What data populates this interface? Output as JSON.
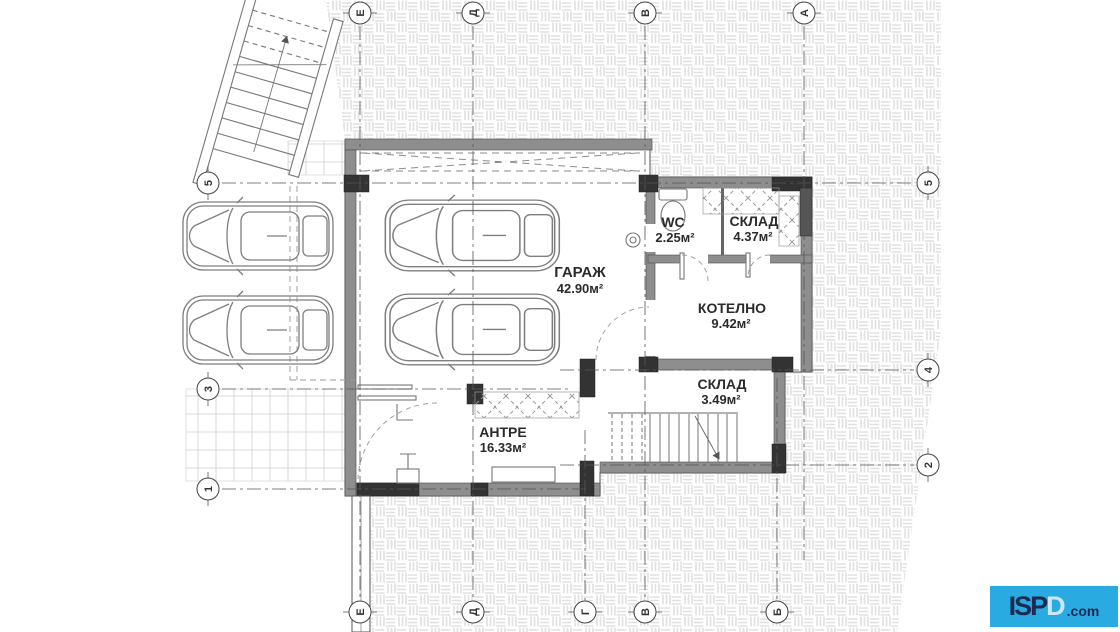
{
  "plan": {
    "rooms": [
      {
        "id": "garage",
        "name": "ГАРАЖ",
        "area": "42.90м²"
      },
      {
        "id": "wc",
        "name": "WC",
        "area": "2.25м²"
      },
      {
        "id": "sklad1",
        "name": "СКЛАД",
        "area": "4.37м²"
      },
      {
        "id": "kotelno",
        "name": "КОТЕЛНО",
        "area": "9.42м²"
      },
      {
        "id": "sklad2",
        "name": "СКЛАД",
        "area": "3.49м²"
      },
      {
        "id": "antre",
        "name": "АНТРЕ",
        "area": "16.33м²"
      }
    ],
    "grid": {
      "top": [
        "Е",
        "Д",
        "В",
        "А"
      ],
      "bottom": [
        "Е",
        "Д",
        "Г",
        "В",
        "Б"
      ],
      "left": [
        "5",
        "3",
        "1"
      ],
      "right": [
        "5",
        "4",
        "2"
      ]
    },
    "colors": {
      "wall": "#8e8e8e",
      "column": "#333333",
      "hatch_line": "#e3e3e3",
      "logo_bg": "#29aae1",
      "logo_text": "#1c2b52"
    }
  },
  "watermark": {
    "brand_prefix": "ISP",
    "brand_d": "D",
    "suffix": ".com"
  }
}
